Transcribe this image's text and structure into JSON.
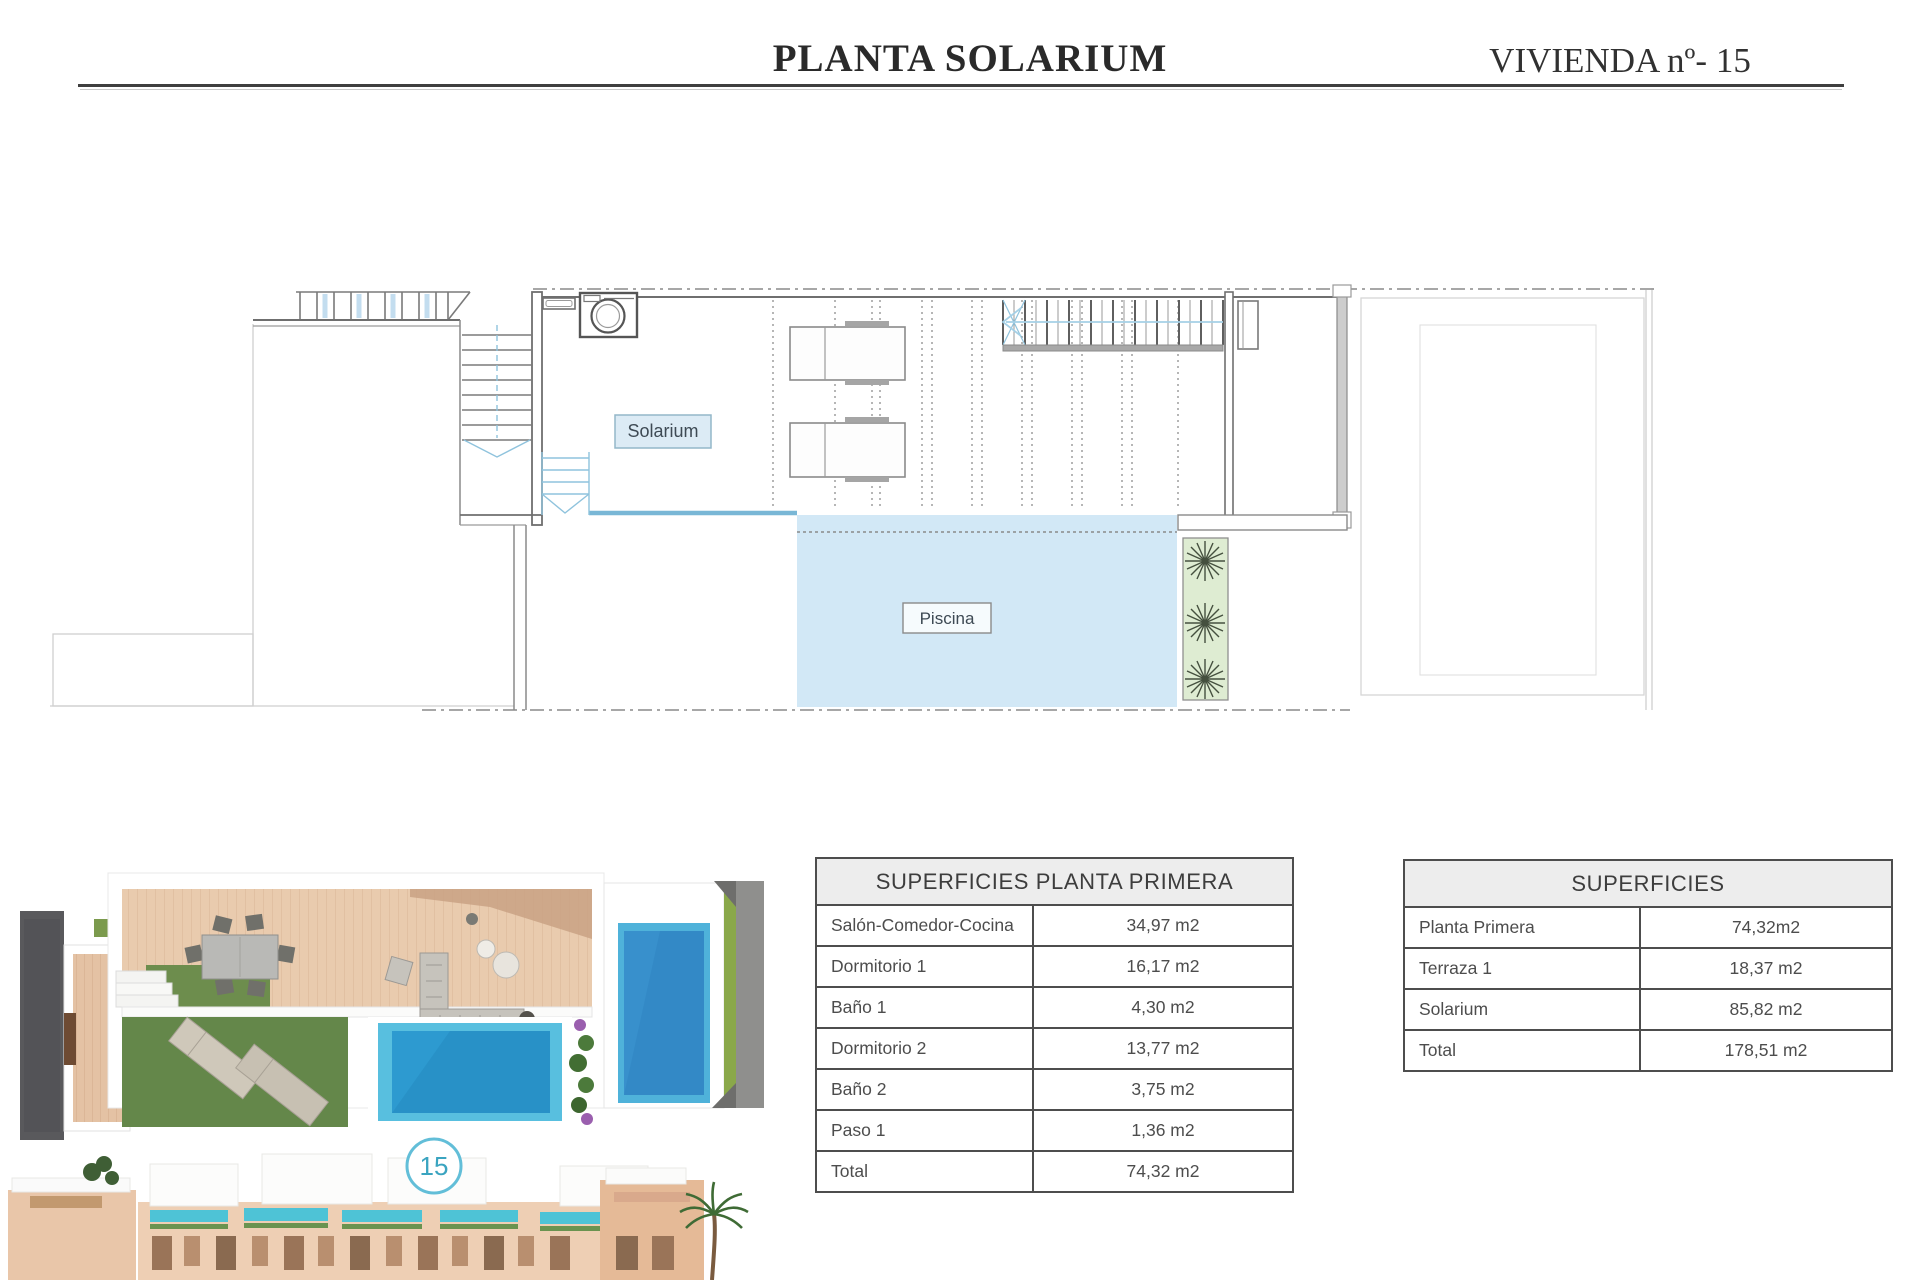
{
  "header": {
    "title": "PLANTA SOLARIUM",
    "unit": "VIVIENDA nº- 15"
  },
  "plan": {
    "solarium_label": "Solarium",
    "piscina_label": "Piscina"
  },
  "tables": {
    "planta_primera": {
      "title": "SUPERFICIES PLANTA PRIMERA",
      "rows": [
        {
          "label": "Salón-Comedor-Cocina",
          "value": "34,97 m2"
        },
        {
          "label": "Dormitorio 1",
          "value": "16,17 m2"
        },
        {
          "label": "Baño 1",
          "value": "4,30 m2"
        },
        {
          "label": "Dormitorio 2",
          "value": "13,77 m2"
        },
        {
          "label": "Baño 2",
          "value": "3,75 m2"
        },
        {
          "label": "Paso 1",
          "value": "1,36 m2"
        },
        {
          "label": "Total",
          "value": "74,32 m2"
        }
      ]
    },
    "superficies": {
      "title": "SUPERFICIES",
      "rows": [
        {
          "label": "Planta Primera",
          "value": "74,32m2"
        },
        {
          "label": "Terraza 1",
          "value": "18,37 m2"
        },
        {
          "label": "Solarium",
          "value": "85,82 m2"
        },
        {
          "label": "Total",
          "value": "178,51 m2"
        }
      ]
    }
  },
  "elevation_badge": {
    "number": "15"
  },
  "colors": {
    "pool_fill": "#d2e8f6",
    "pool_edge_blue": "#79b7d6",
    "stair_accent_blue": "#8fc3dd",
    "label_fill": "#dcebf5",
    "planter_green": "#deecd2",
    "table_header_bg": "#ededed",
    "badge_teal": "#5bbcd4",
    "render_lawn_green": "#64874a",
    "render_water_blue": "#2d9ad0",
    "render_deck_wood": "#e9cbae"
  }
}
